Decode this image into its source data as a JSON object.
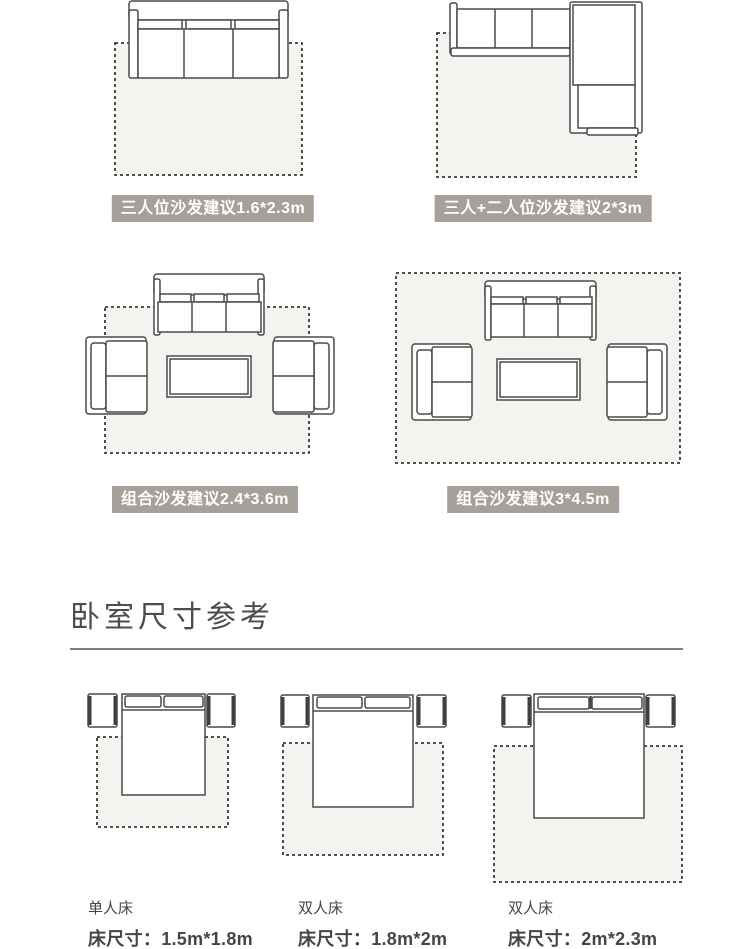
{
  "living": {
    "badges": [
      "三人位沙发建议1.6*2.3m",
      "三人+二人位沙发建议2*3m",
      "组合沙发建议2.4*3.6m",
      "组合沙发建议3*4.5m"
    ]
  },
  "bedroom": {
    "heading": "卧室尺寸参考",
    "beds": [
      {
        "type": "单人床",
        "size": "床尺寸：1.5m*1.8m"
      },
      {
        "type": "双人床",
        "size": "床尺寸：1.8m*2m"
      },
      {
        "type": "双人床",
        "size": "床尺寸：2m*2.3m"
      }
    ]
  },
  "colors": {
    "badge_background": "#a5a09a",
    "badge_text": "#ffffff",
    "rug_fill": "#f5f3ef",
    "line": "#4a4a4a",
    "heading_text": "#4c4c4c"
  }
}
